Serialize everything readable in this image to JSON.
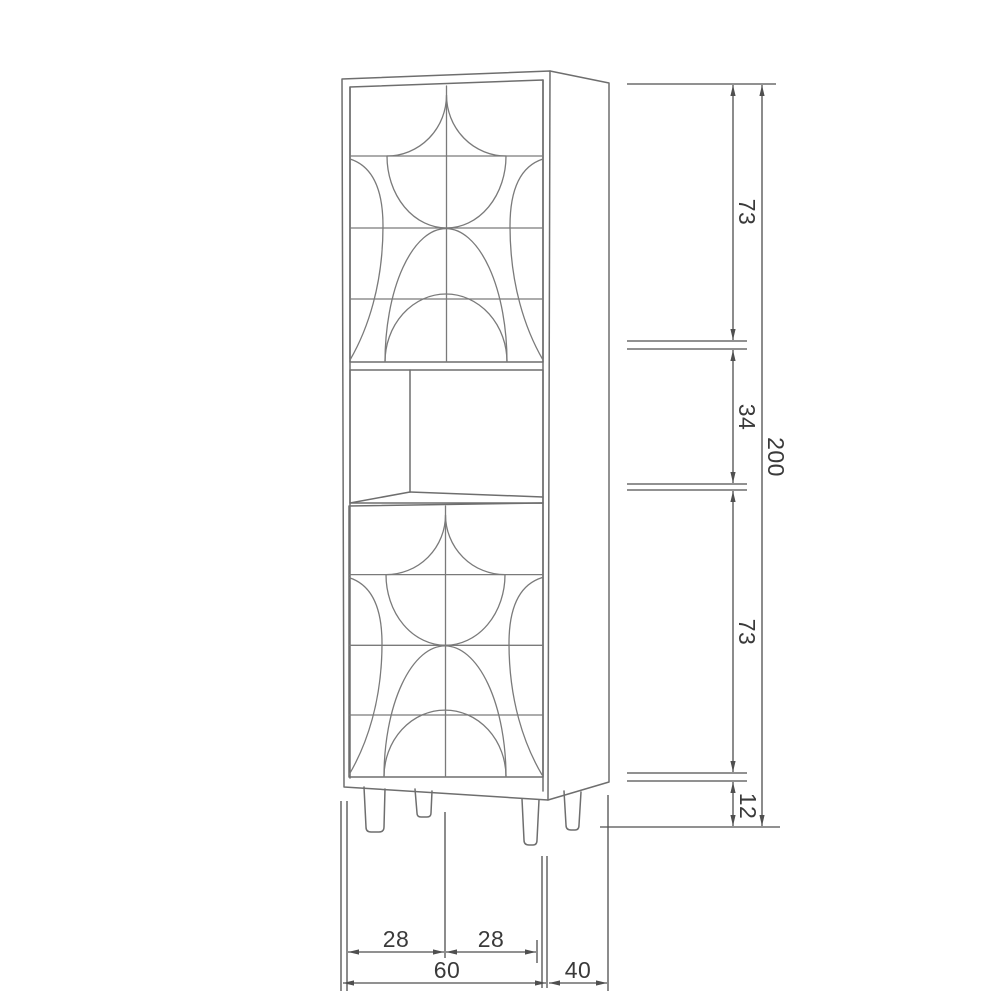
{
  "diagram": {
    "kind": "furniture dimension drawing",
    "subject": "tall cabinet with two patterned doors, open shelf and legs"
  },
  "dimensions": {
    "top_section_height": "73",
    "middle_section_height": "34",
    "bottom_section_height": "73",
    "legs_height": "12",
    "total_height": "200",
    "left_half_width": "28",
    "right_half_width": "28",
    "total_width": "60",
    "depth": "40"
  },
  "colors": {
    "background": "#ffffff",
    "cabinet_line": "#6e6e6e",
    "pattern_line": "#7a7a7a",
    "dimension_line": "#4f4f4f",
    "text": "#3a3a3a"
  }
}
